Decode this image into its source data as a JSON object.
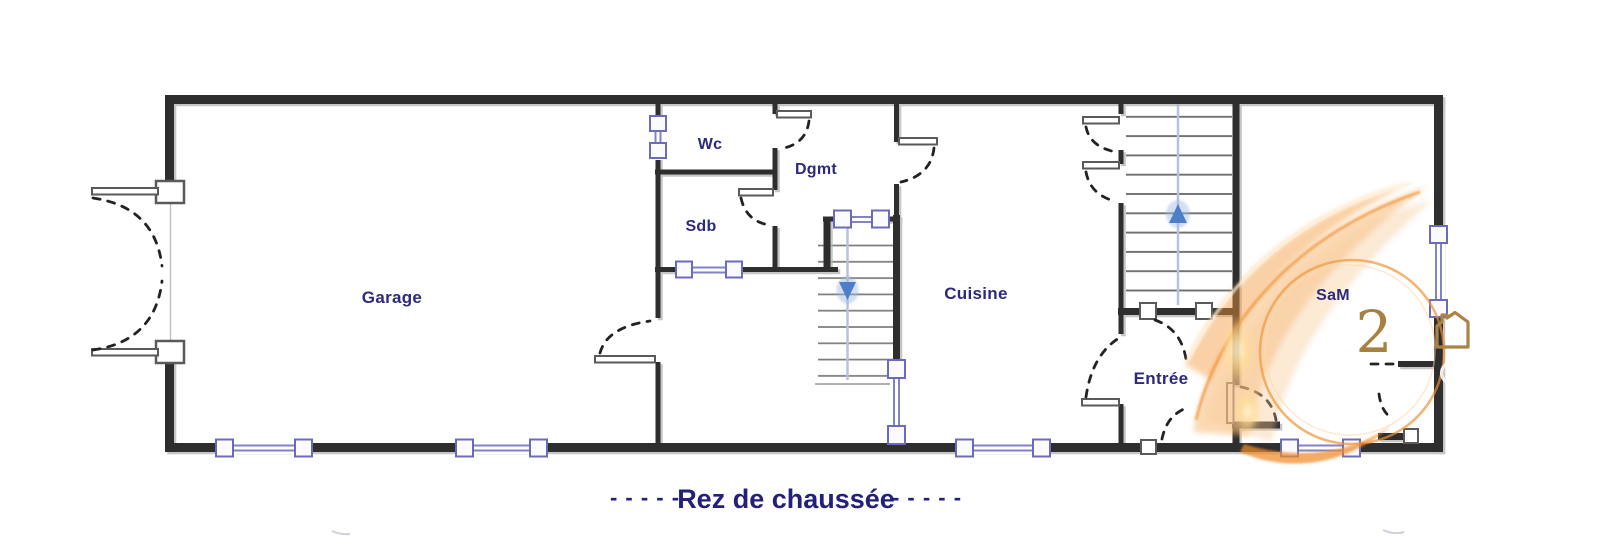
{
  "page": {
    "background": "#ffffff"
  },
  "plan": {
    "rooms": {
      "garage": "Garage",
      "wc": "Wc",
      "sdb": "Sdb",
      "dgmt": "Dgmt",
      "cuisine": "Cuisine",
      "entree": "Entrée",
      "sam": "SaM"
    },
    "caption": {
      "left_dashes": "- - - - -",
      "text": "Rez de chaussée",
      "right_dashes": "- - - - -"
    },
    "icons": {
      "stairs_down_arrow": "arrow-down",
      "stairs_up_arrow": "arrow-up"
    }
  },
  "watermark": {
    "number": "2",
    "icon": "house-outline"
  },
  "colors": {
    "wall": "#2e2e2e",
    "room_label": "#2b2a7d",
    "caption": "#23207b",
    "window_blue": "#7b7bc8",
    "stair_arrow_blue": "#4d7ec8",
    "watermark_orange": "#f39a3c",
    "watermark_gold": "#a8803f"
  }
}
